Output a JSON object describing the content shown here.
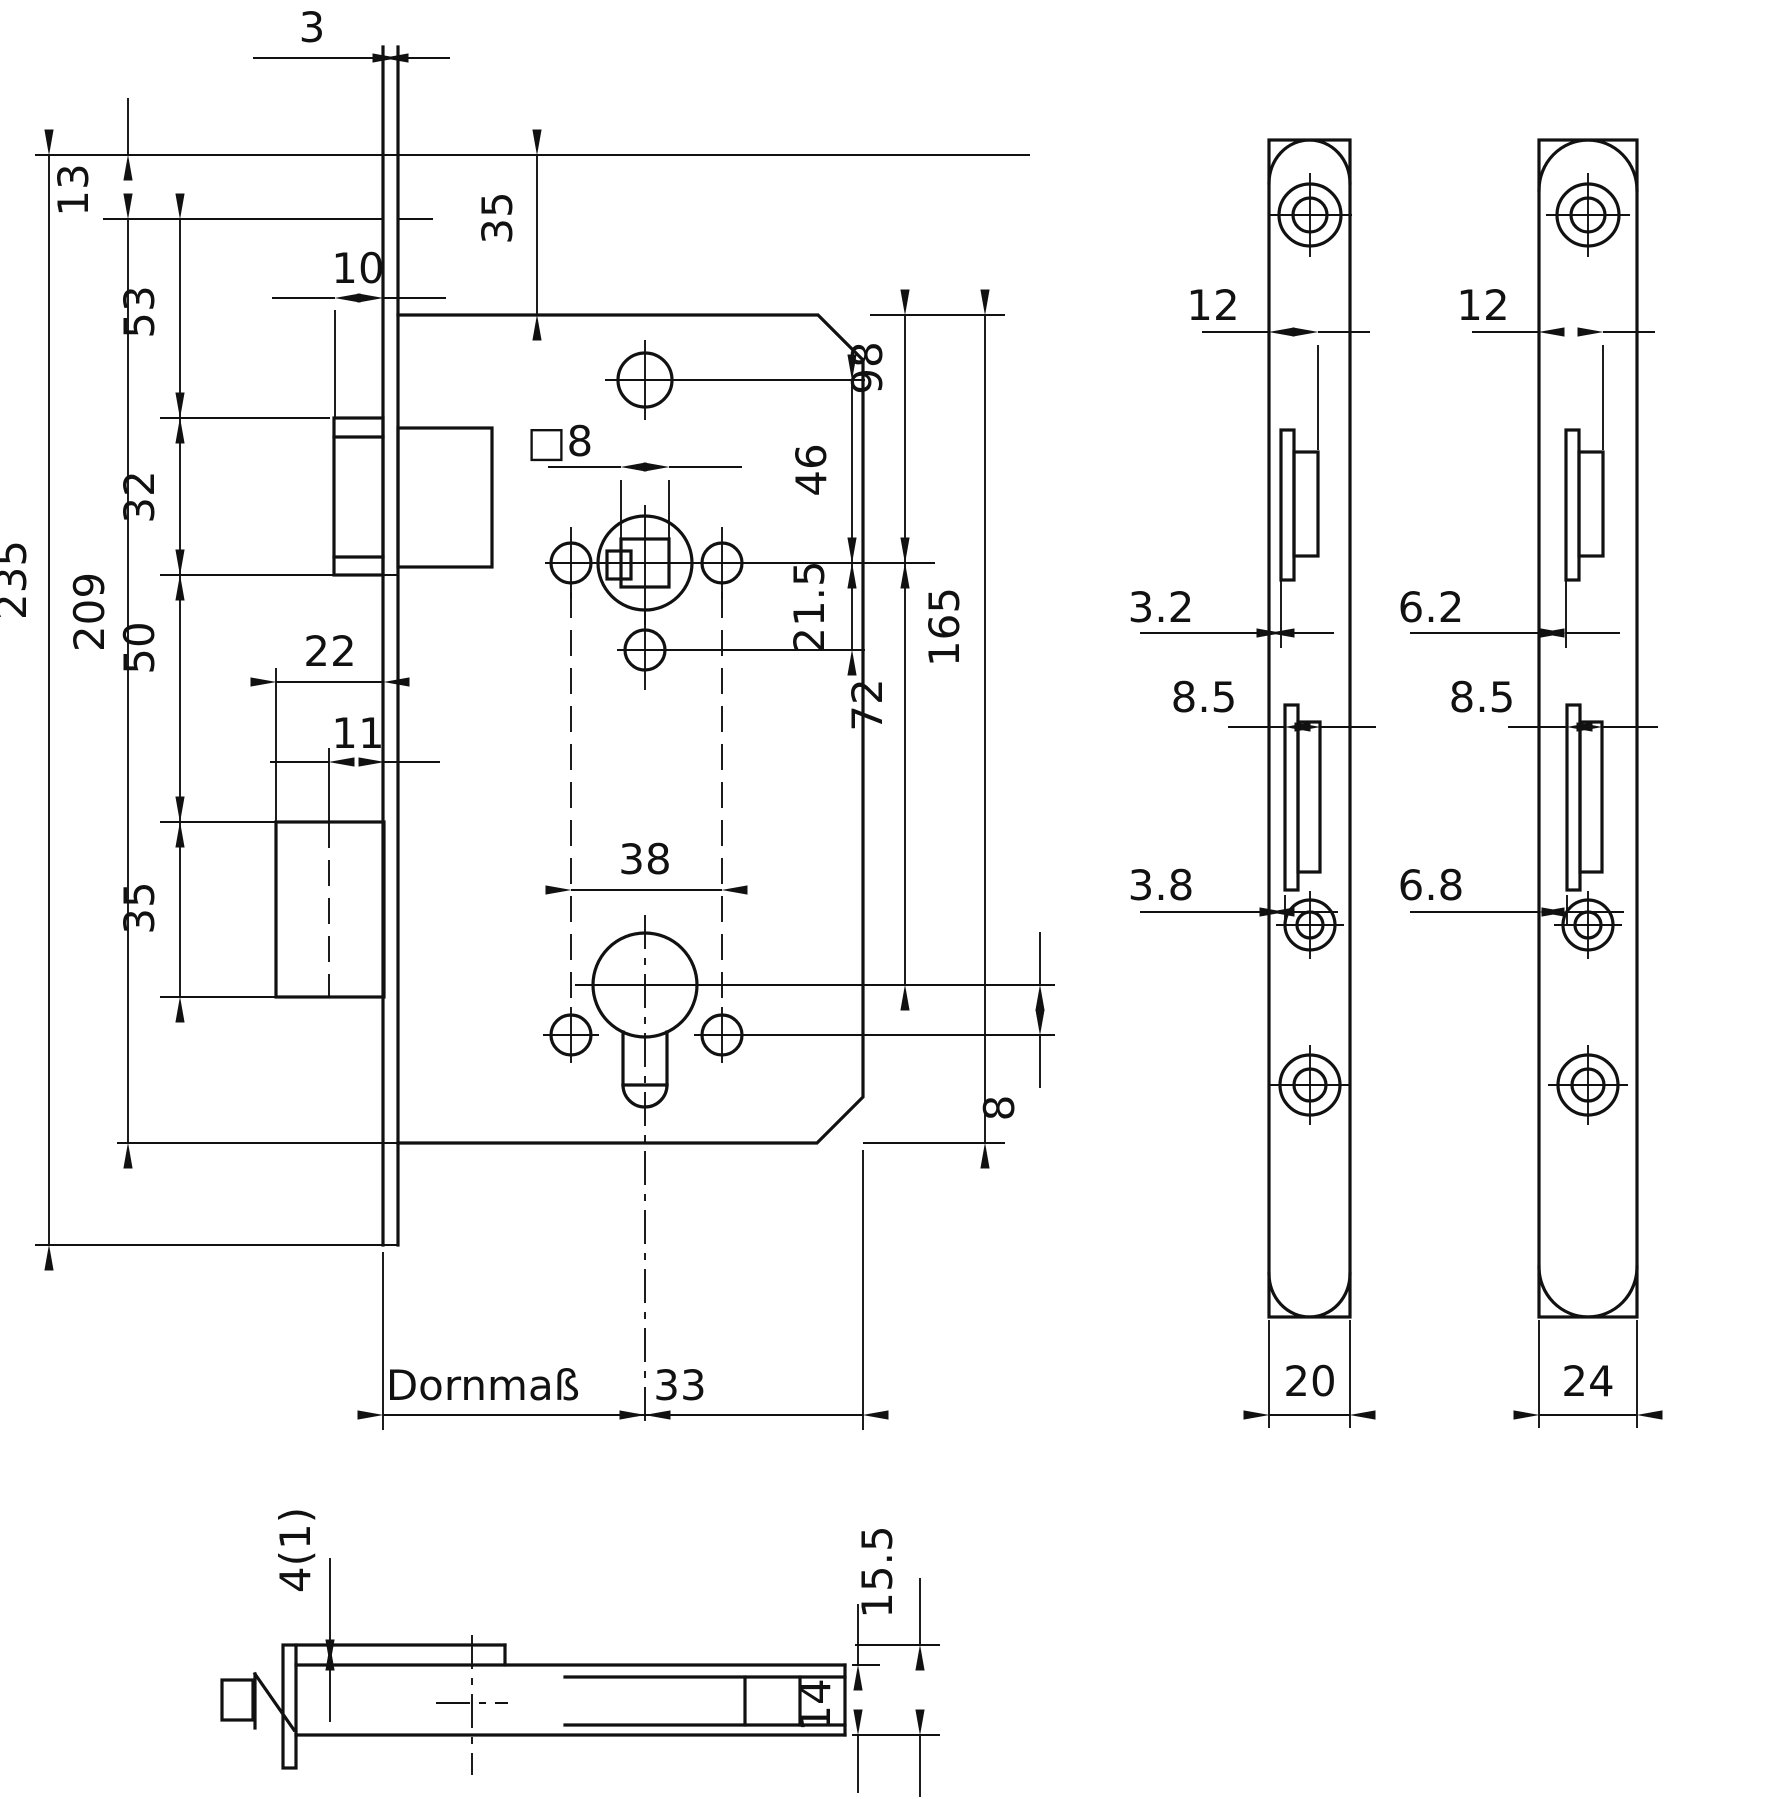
{
  "drawing": {
    "main": {
      "d3": "3",
      "d13": "13",
      "d53": "53",
      "d32": "32",
      "d50": "50",
      "d35l": "35",
      "d235": "235",
      "d209": "209",
      "d10": "10",
      "d22": "22",
      "d11": "11",
      "d35t": "35",
      "dsq8": "□8",
      "d98": "98",
      "d46": "46",
      "d215": "21.5",
      "d165": "165",
      "d72": "72",
      "d8": "8",
      "d38": "38",
      "dornmass": "Dornmaß",
      "d33": "33"
    },
    "plate20": {
      "d12": "12",
      "d32": "3.2",
      "d85": "8.5",
      "d38": "3.8",
      "w": "20"
    },
    "plate24": {
      "d12": "12",
      "d62": "6.2",
      "d85": "8.5",
      "d68": "6.8",
      "w": "24"
    },
    "bottom": {
      "d41": "4(1)",
      "d155": "15.5",
      "d14": "14"
    }
  }
}
